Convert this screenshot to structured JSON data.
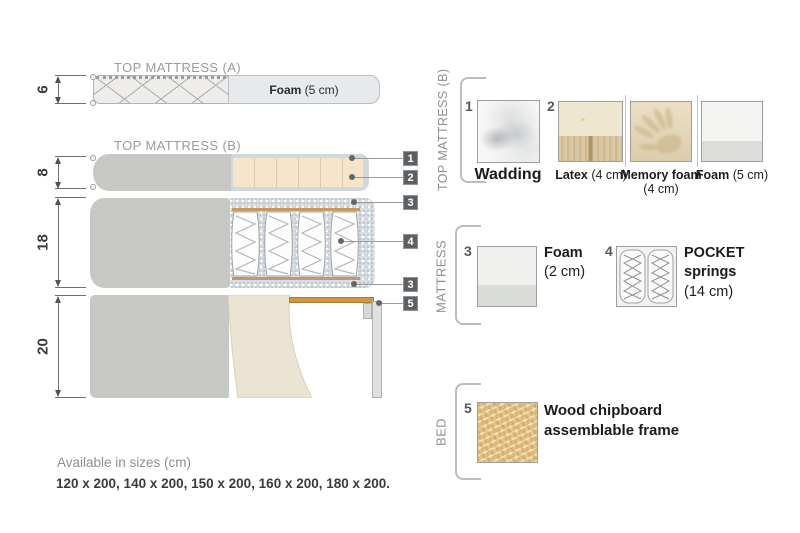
{
  "diagram": {
    "top_mattress_a": {
      "title": "TOP MATTRESS (A)",
      "foam_name": "Foam",
      "foam_size": " (5 cm)"
    },
    "top_mattress_b": {
      "title": "TOP MATTRESS (B)"
    },
    "dims": {
      "a": "6",
      "b": "8",
      "mattress": "18",
      "bed": "20"
    },
    "callouts": [
      "1",
      "2",
      "3",
      "4",
      "3",
      "5"
    ]
  },
  "legend": {
    "top_mattress_b": {
      "title": "TOP MATTRESS (B)",
      "items": [
        {
          "num": "1",
          "name": "Wadding",
          "size": ""
        },
        {
          "num": "2",
          "name": "Latex",
          "size": " (4 cm)"
        },
        {
          "num": "",
          "name": "Memory foam",
          "size": " (4 cm)"
        },
        {
          "num": "",
          "name": "Foam",
          "size": " (5 cm)"
        }
      ]
    },
    "mattress": {
      "title": "MATTRESS",
      "items": [
        {
          "num": "3",
          "name": "Foam",
          "size": "(2 cm)"
        },
        {
          "num": "4",
          "name": "POCKET springs",
          "size": "(14 cm)"
        }
      ]
    },
    "bed": {
      "title": "BED",
      "items": [
        {
          "num": "5",
          "name": "Wood chipboard assemblable frame",
          "size": ""
        }
      ]
    }
  },
  "footer": {
    "sizes_title": "Available in sizes (cm)",
    "sizes_list": "120 x 200, 140 x 200, 150 x 200, 160 x 200, 180 x 200."
  },
  "colors": {
    "fabric_gray": "#c7c8c3",
    "latex_beige": "#f6e5cb",
    "wadding_blue": "#cfd9dd",
    "foam_light": "#e7eaec",
    "wood": "#d29742",
    "callout_bg": "#5c6063",
    "text_dark": "#3b3b3b",
    "text_gray": "#8f8f8f"
  }
}
